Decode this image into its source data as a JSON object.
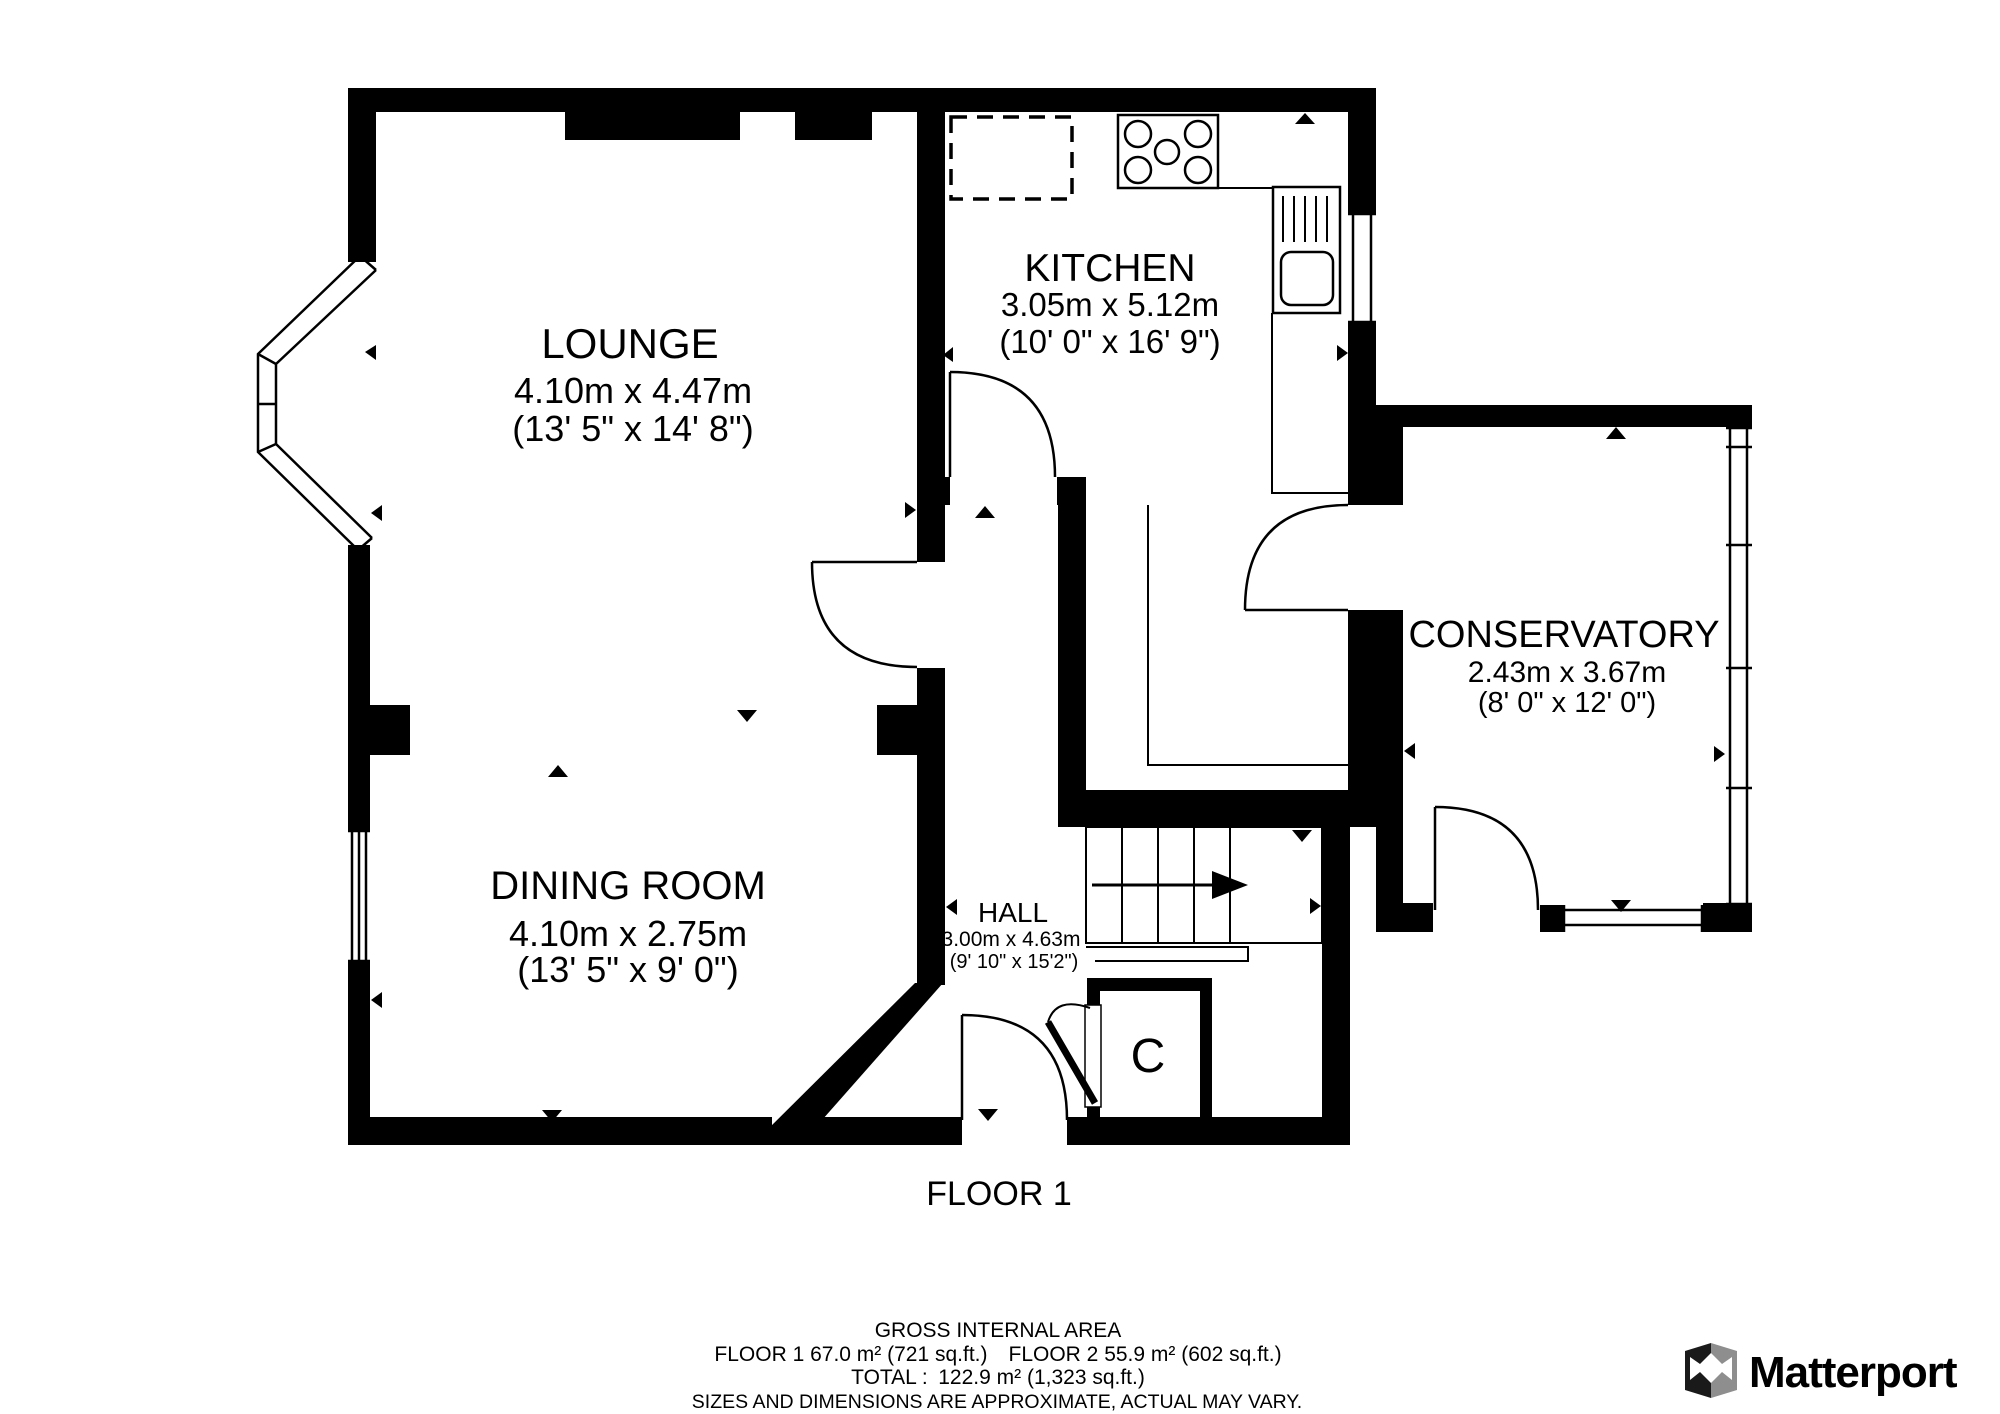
{
  "colors": {
    "wall": "#000000",
    "background": "#ffffff",
    "note_gray": "#9b9b9b",
    "logo_text": "#3e3e3e",
    "logo_gray": "#8e8e8e"
  },
  "rooms": {
    "lounge": {
      "name": "LOUNGE",
      "metric": "4.10m x 4.47m",
      "imperial": "(13' 5\" x 14' 8\")"
    },
    "kitchen": {
      "name": "KITCHEN",
      "metric": "3.05m x 5.12m",
      "imperial": "(10' 0\" x 16' 9\")"
    },
    "conservatory": {
      "name": "CONSERVATORY",
      "metric": "2.43m x 3.67m",
      "imperial": "(8' 0\" x 12' 0\")"
    },
    "dining": {
      "name": "DINING ROOM",
      "metric": "4.10m x 2.75m",
      "imperial": "(13' 5\" x 9' 0\")"
    },
    "hall": {
      "name": "HALL",
      "metric": "3.00m x 4.63m",
      "imperial": "(9' 10\" x 15'2\")"
    },
    "closet": {
      "name": "C"
    }
  },
  "floor_label": "FLOOR 1",
  "footer": {
    "title": "GROSS INTERNAL AREA",
    "line1": "FLOOR 1 67.0 m² (721 sq.ft.) FLOOR 2 55.9 m² (602 sq.ft.)",
    "line2": "TOTAL : 122.9 m² (1,323 sq.ft.)",
    "note": "SIZES AND DIMENSIONS ARE APPROXIMATE, ACTUAL MAY VARY."
  },
  "brand": {
    "name": "Matterport"
  }
}
